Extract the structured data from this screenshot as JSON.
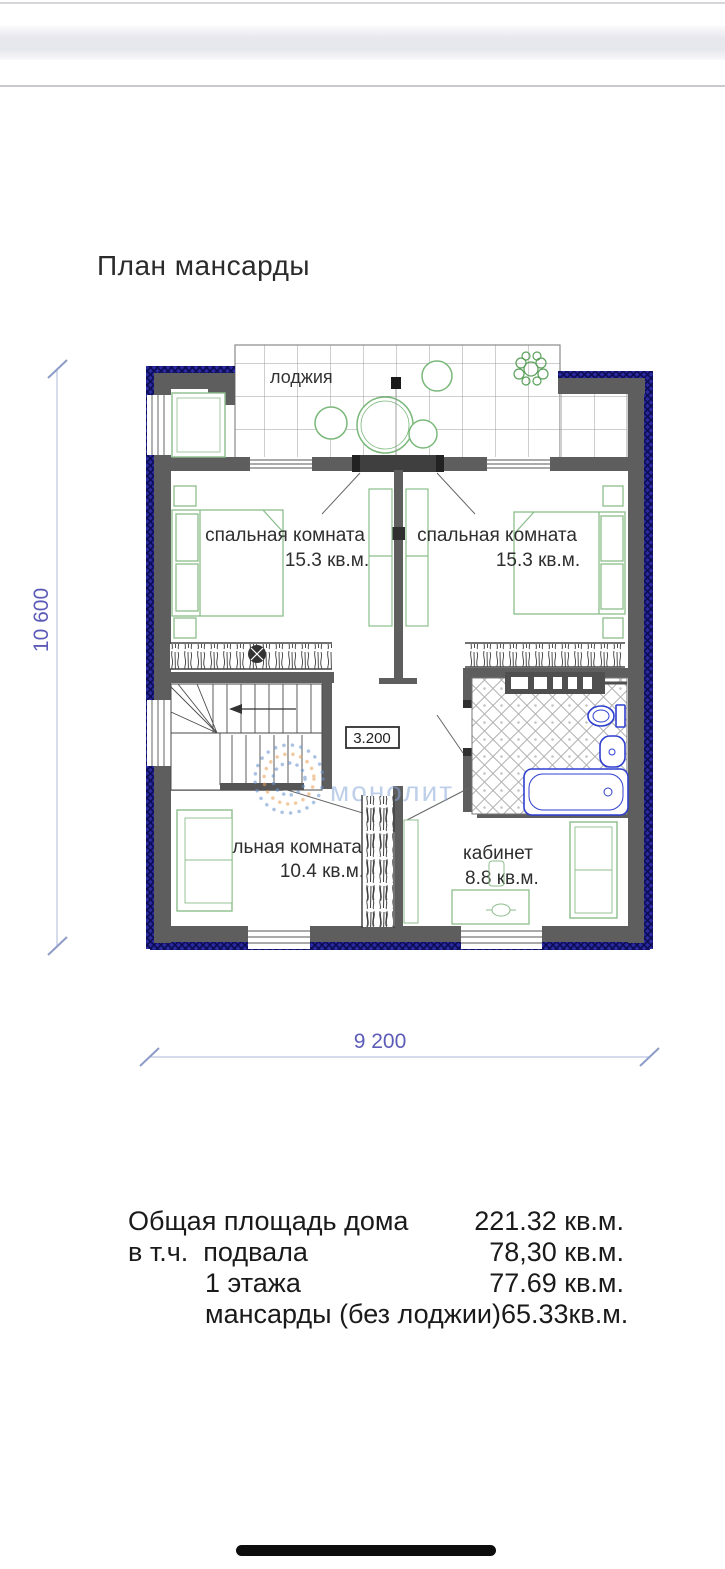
{
  "page": {
    "title": "План мансарды"
  },
  "plan": {
    "loggia_label": "лоджия",
    "rooms": [
      {
        "name": "спальная комната",
        "area": "15.3 кв.м."
      },
      {
        "name": "спальная комната",
        "area": "15.3 кв.м."
      },
      {
        "name": "спальная комната",
        "area": "10.4 кв.м."
      },
      {
        "name": "кабинет",
        "area": "8.8 кв.м."
      }
    ],
    "level_mark": "3.200",
    "dims": {
      "height": "10 600",
      "width": "9 200"
    },
    "watermark": "монолит"
  },
  "summary": {
    "rows": [
      {
        "label": "Общая площадь дома",
        "value": "221.32 кв.м."
      },
      {
        "label": "в т.ч.  подвала",
        "value": "78,30 кв.м."
      },
      {
        "label": "1 этажа",
        "value": "77.69 кв.м."
      },
      {
        "label": "мансарды (без лоджии)",
        "value": "65.33кв.м."
      }
    ]
  },
  "colors": {
    "wall_gray": "#5e5e5e",
    "hatch_navy": "#2323a0",
    "furniture_green": "#8bbd8b",
    "plumbing_blue": "#2f3fd0",
    "dimension_blue": "#5c5cb8",
    "watermark_blue": "#8aa8d8"
  }
}
